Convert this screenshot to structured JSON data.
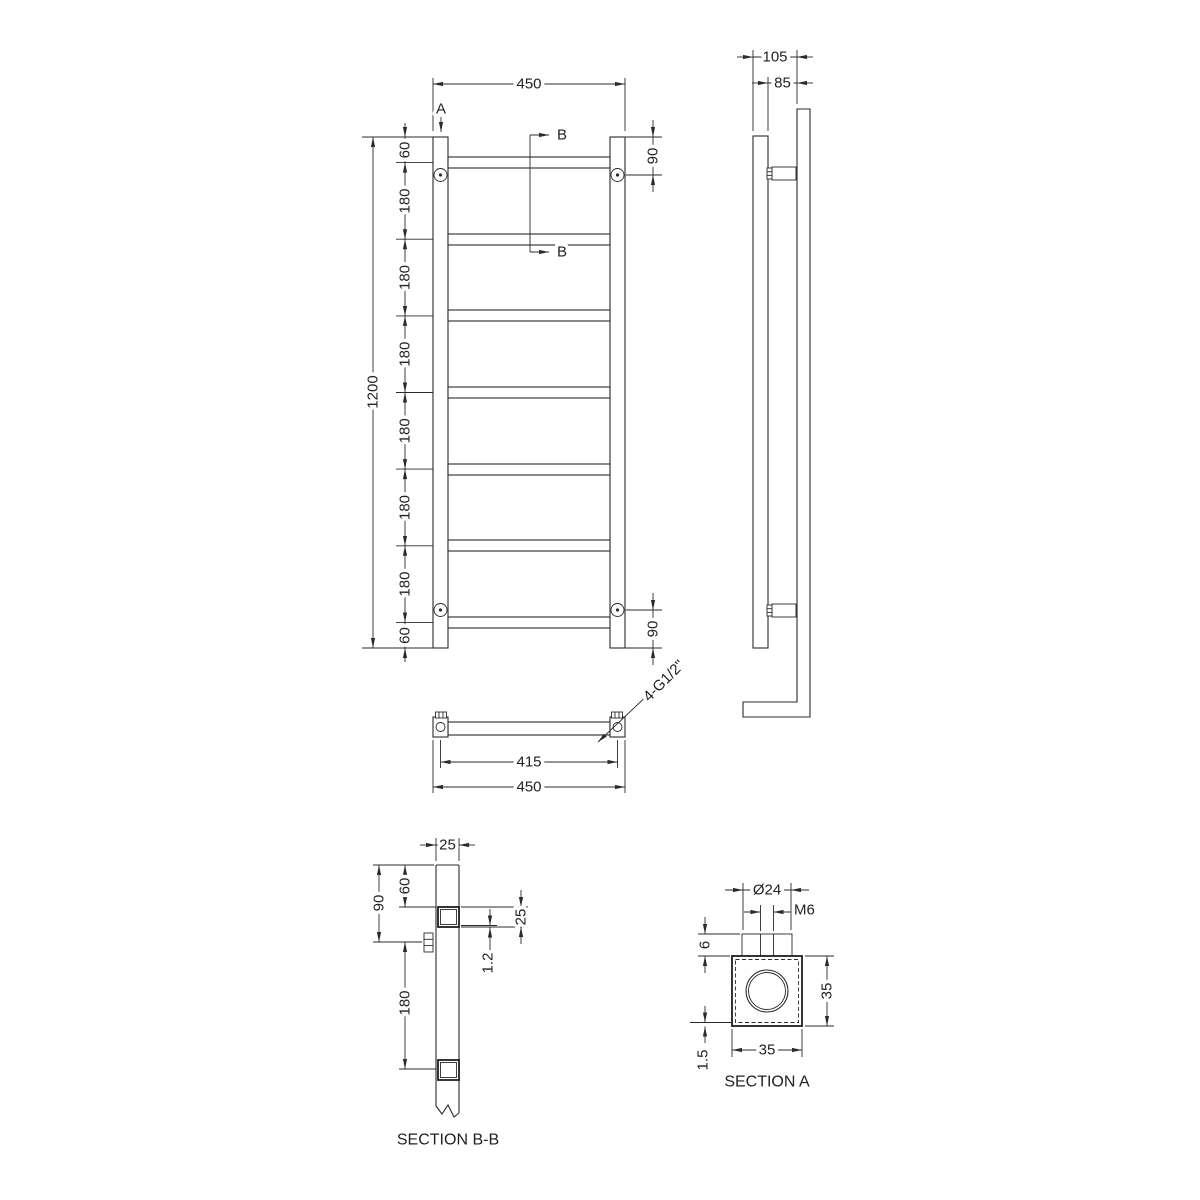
{
  "drawing": {
    "front": {
      "overall_width": "450",
      "overall_height": "1200",
      "top_offset": "60",
      "rung_pitch": "180",
      "screw_offset": "90",
      "bottom_offset": "60",
      "section_a_marker": "A",
      "section_b_marker": "B"
    },
    "side": {
      "overall_depth": "105",
      "wall_gap": "85"
    },
    "plan": {
      "hole_centers": "415",
      "overall_width": "450",
      "connection": "4-G1/2\""
    },
    "section_bb": {
      "label": "SECTION B-B",
      "tube_width": "25",
      "top_offset": "60",
      "bracket_offset": "90",
      "rung_pitch": "180",
      "rung_size": "25",
      "wall_thickness": "1.2"
    },
    "section_a": {
      "label": "SECTION A",
      "bore": "Ø24",
      "thread": "M6",
      "boss_height": "6",
      "height": "35",
      "width": "35",
      "wall_thickness": "1.5"
    }
  }
}
